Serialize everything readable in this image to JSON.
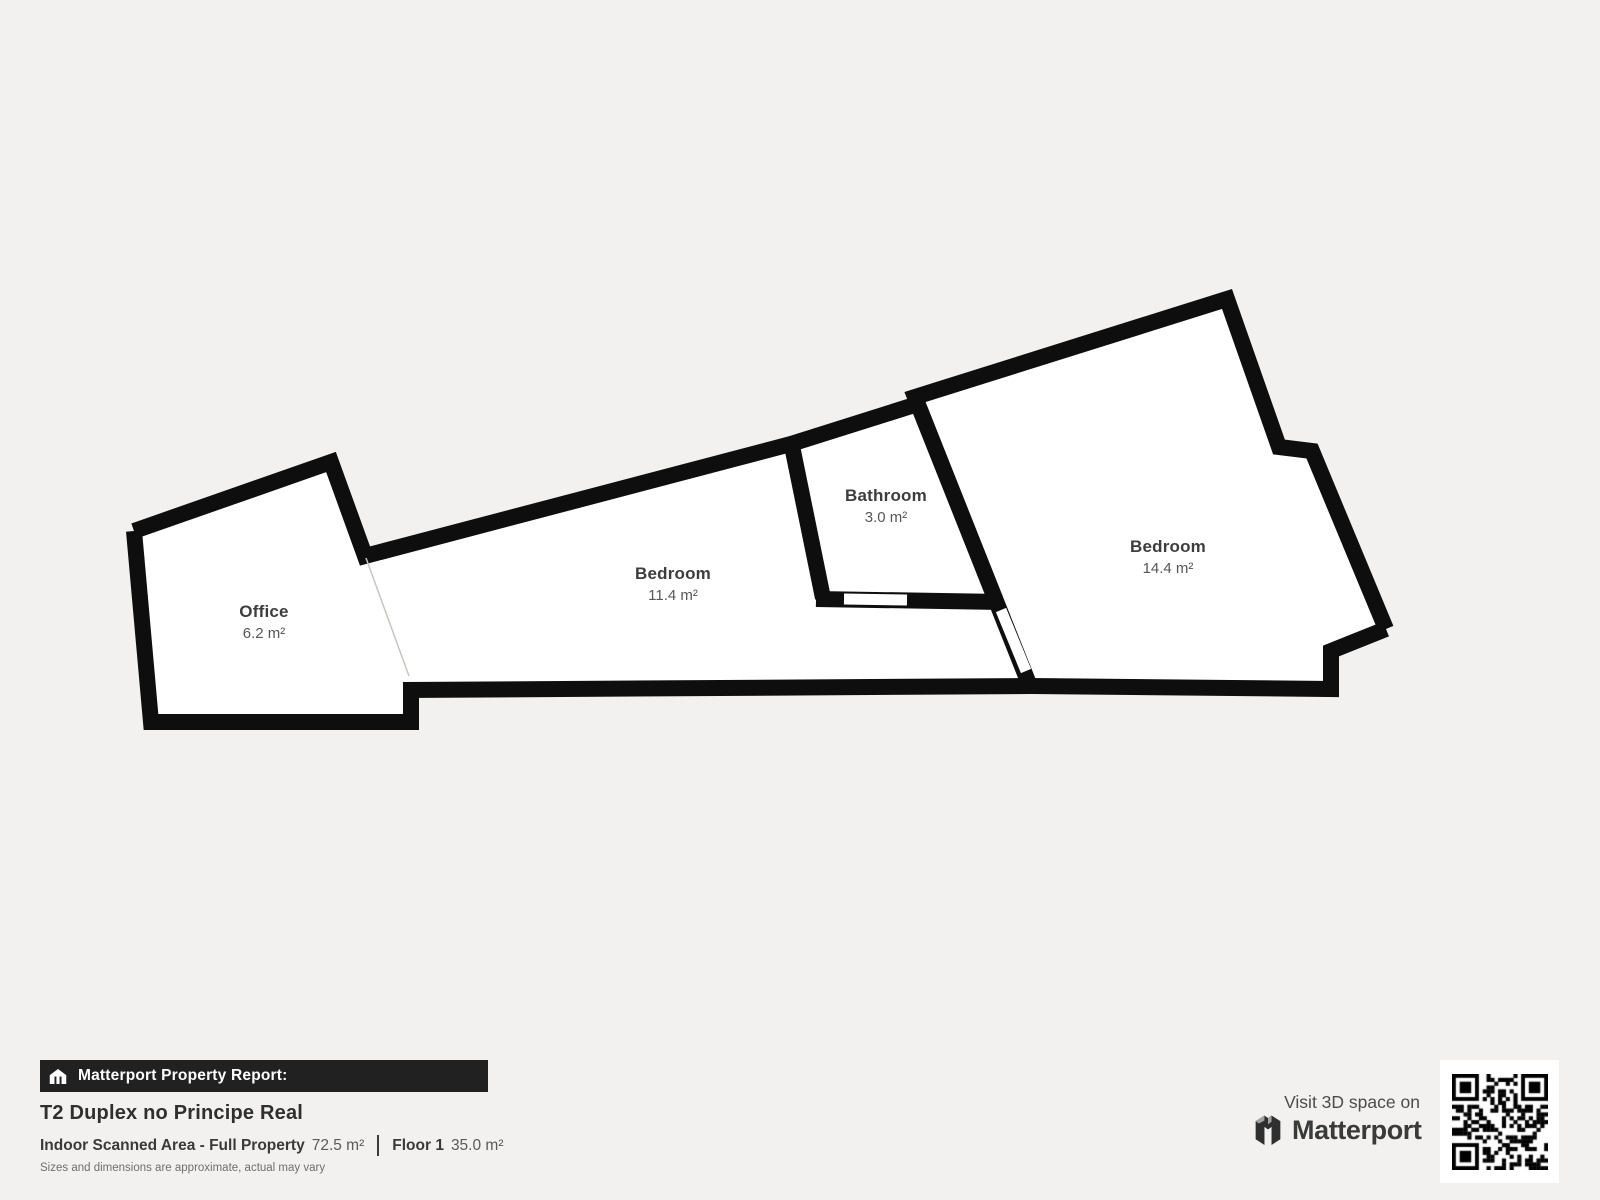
{
  "page": {
    "background": "#f2f1ef"
  },
  "colors": {
    "wall": "#0e0e0e",
    "floor": "#ffffff",
    "banner_background": "#212121",
    "banner_text": "#ffffff",
    "room_name_text": "#3d3d3d",
    "room_area_text": "#565656"
  },
  "icons": {
    "banner_icon": "house-icon",
    "brand_icon": "matterport-m-icon",
    "qr": "qr-code"
  },
  "floorplan": {
    "rooms": [
      {
        "name": "Office",
        "area": "6.2 m²"
      },
      {
        "name": "Bedroom",
        "area": "11.4 m²"
      },
      {
        "name": "Bathroom",
        "area": "3.0 m²"
      },
      {
        "name": "Bedroom",
        "area": "14.4 m²"
      }
    ]
  },
  "report": {
    "banner_label": "Matterport Property Report:",
    "property_title": "T2 Duplex no Principe Real",
    "scanned_area_label": "Indoor Scanned Area - Full Property",
    "scanned_area_value": "72.5 m²",
    "floor_label": "Floor 1",
    "floor_value": "35.0 m²",
    "disclaimer": "Sizes and dimensions are approximate, actual may vary"
  },
  "promo": {
    "visit_text": "Visit 3D space on",
    "brand": "Matterport"
  }
}
